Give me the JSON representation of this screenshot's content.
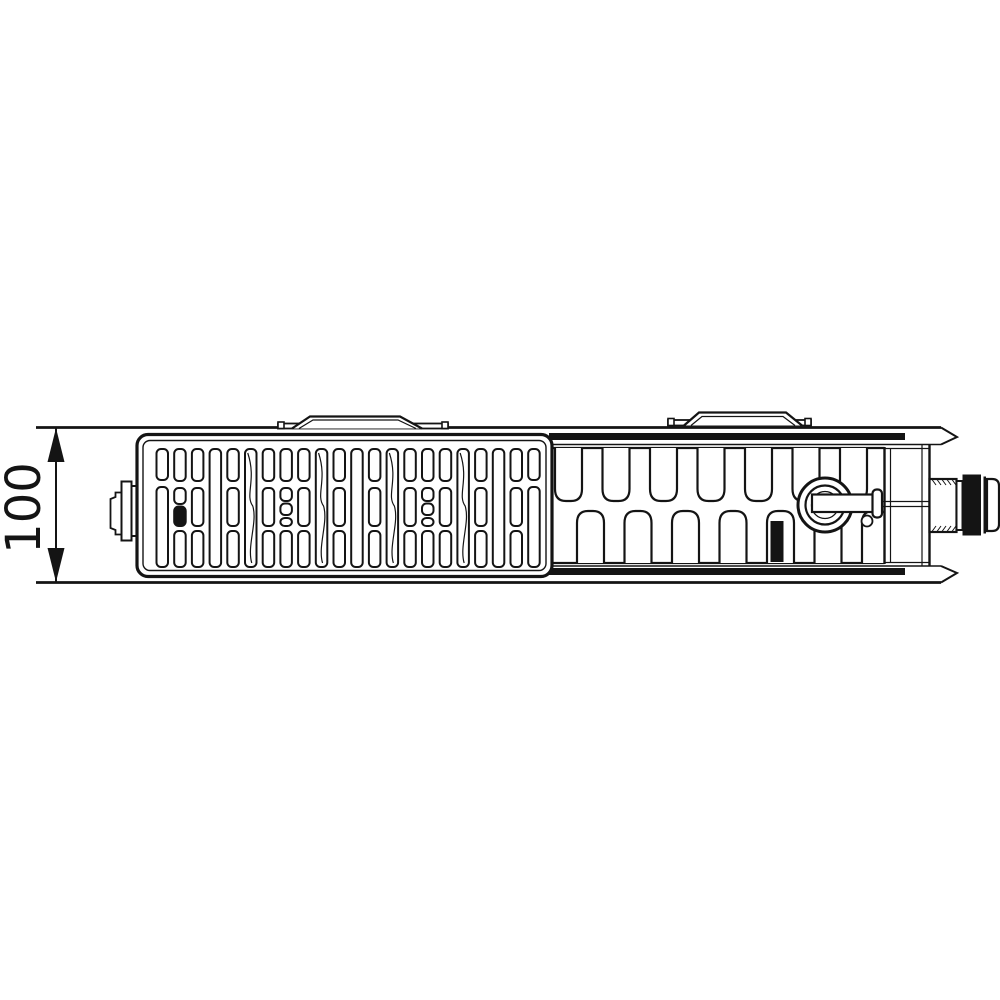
{
  "canvas": {
    "background": "#ffffff",
    "ink": "#141414"
  },
  "dimension": {
    "label": "100",
    "orientation": "vertical"
  },
  "grille": {
    "x_start": 156.5,
    "pitch": 17.7,
    "slot_width": 11.5,
    "columns": [
      "tall2",
      "dark",
      "three",
      "full",
      "three",
      "fullS",
      "three",
      "split",
      "three",
      "fullS",
      "three",
      "full",
      "three",
      "fullS",
      "three",
      "split",
      "three",
      "fullS",
      "three",
      "full",
      "three",
      "tall2"
    ]
  },
  "fins": {
    "pitch": 47.5,
    "width": 27,
    "top_start": 555,
    "bottom_start": 577,
    "count": 7
  }
}
